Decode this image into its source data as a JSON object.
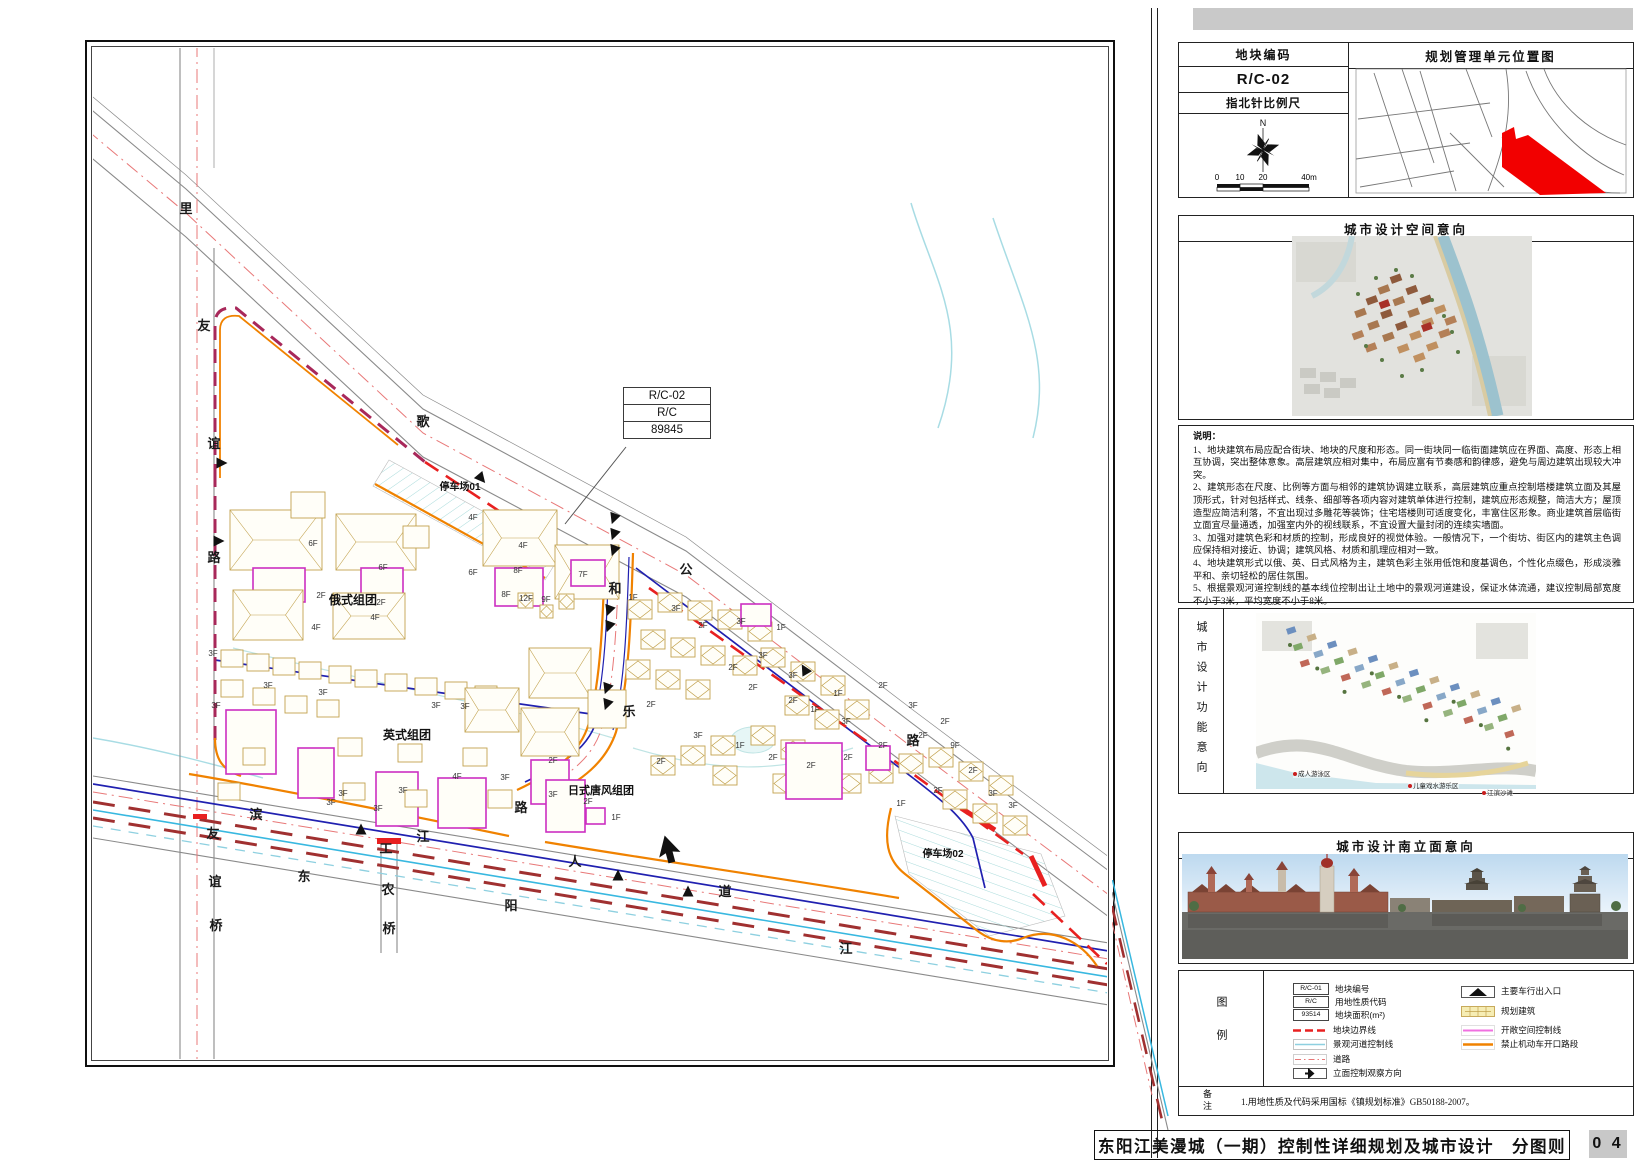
{
  "title_bar": {
    "title": "东阳江美漫城（一期）控制性详细规划及城市设计　分图则",
    "page_no": "0 4"
  },
  "info_table": {
    "code_label": "地块编码",
    "code_value": "R/C-02",
    "compass_label": "指北针比例尺",
    "north": "N",
    "scale_ticks": [
      "0",
      "10",
      "20",
      "40m"
    ],
    "location_title": "规划管理单元位置图"
  },
  "panels": {
    "space_title": "城市设计空间意向",
    "function_title": "城市设计功能意向",
    "elevation_title": "城市设计南立面意向",
    "legend_title": "图例",
    "remark_title": "备注"
  },
  "notes": {
    "title": "说明：",
    "items": [
      "1、地块建筑布局应配合街块、地块的尺度和形态。同一街块同一临街面建筑应在界面、高度、形态上相互协调，突出整体意象。高层建筑应相对集中，布局应富有节奏感和韵律感，避免与周边建筑出现较大冲突。",
      "2、建筑形态在尺度、比例等方面与相邻的建筑协调建立联系，高层建筑应重点控制塔楼建筑立面及其屋顶形式，针对包括样式、线条、细部等各项内容对建筑单体进行控制，建筑应形态规整，简洁大方；屋顶造型应简洁利落，不宜出现过多雕花等装饰；住宅塔楼则可适度变化，丰富住区形象。商业建筑首层临街立面宜尽量通透，加强室内外的视线联系，不宜设置大量封闭的连续实墙面。",
      "3、加强对建筑色彩和材质的控制，形成良好的视觉体验。一般情况下，一个街坊、街区内的建筑主色调应保持相对接近、协调；建筑风格、材质和肌理应相对一致。",
      "4、地块建筑形式以俄、英、日式风格为主，建筑色彩主张用低饱和度基调色，个性化点缀色，形成淡雅平和、亲切轻松的居住氛围。",
      "5、根据景观河道控制线的基本线位控制出让土地中的景观河道建设，保证水体流通，建议控制局部宽度不小于3米，平均宽度不小于8米。",
      "6、基地多砂岩地层，建议开发时整体地坪抬高1-1.5米，便于地下车库与景观河道的设置。",
      "7、建筑造型及立面材质、颜色应以城市设计的空间意向与立面意向为基础进行下一步的初步方案设计，业态功能方面也需与城市设计相衔接。"
    ]
  },
  "function_labels": [
    {
      "t": "成人游泳区",
      "x": 1293,
      "y": 771
    },
    {
      "t": "儿童戏水游乐区",
      "x": 1408,
      "y": 783
    },
    {
      "t": "江滨沙滩",
      "x": 1482,
      "y": 790
    }
  ],
  "legend": {
    "col1": [
      {
        "box": "R/C-01",
        "label": "地块编号"
      },
      {
        "box": "R/C",
        "label": "用地性质代码"
      },
      {
        "box": "93514",
        "label": "地块面积(m²)"
      },
      {
        "type": "red-dash",
        "label": "地块边界线"
      },
      {
        "type": "canal",
        "label": "景观河道控制线"
      },
      {
        "type": "road",
        "label": "道路"
      },
      {
        "type": "view-arrow",
        "label": "立面控制观察方向"
      }
    ],
    "col2": [
      {
        "type": "entry",
        "label": "主要车行出入口"
      },
      {
        "type": "bldg",
        "label": "规划建筑"
      },
      {
        "type": "open",
        "label": "开敞空间控制线"
      },
      {
        "type": "noopen",
        "label": "禁止机动车开口路段"
      }
    ]
  },
  "remark_text": "1.用地性质及代码采用国标《镇规划标准》GB50188-2007。",
  "colors": {
    "tan": "#c2a24e",
    "magenta": "#cc2fc2",
    "navy": "#2020b0",
    "orange": "#f08200",
    "red": "#e82020",
    "maroon": "#a8285a",
    "road_dash": "#e87878",
    "cyan": "#38b8e0",
    "pale_cyan": "#a9dbdb",
    "grey_road": "#8a8a8a"
  },
  "map": {
    "callout": [
      "R/C-02",
      "R/C",
      "89845"
    ],
    "road_labels": [
      [
        93,
        165,
        "里"
      ],
      [
        111,
        282,
        "友"
      ],
      [
        121,
        400,
        "谊"
      ],
      [
        121,
        514,
        "路"
      ],
      [
        120,
        790,
        "友"
      ],
      [
        122,
        838,
        "谊"
      ],
      [
        123,
        882,
        "桥"
      ],
      [
        330,
        378,
        "歌"
      ],
      [
        593,
        526,
        "公"
      ],
      [
        820,
        697,
        "路"
      ],
      [
        522,
        545,
        "和"
      ],
      [
        536,
        668,
        "乐"
      ],
      [
        428,
        764,
        "路"
      ],
      [
        163,
        771,
        "滨"
      ],
      [
        330,
        793,
        "江"
      ],
      [
        482,
        818,
        "人"
      ],
      [
        632,
        848,
        "道"
      ],
      [
        211,
        833,
        "东"
      ],
      [
        418,
        862,
        "阳"
      ],
      [
        753,
        905,
        "江"
      ],
      [
        293,
        805,
        "工"
      ],
      [
        295,
        846,
        "农"
      ],
      [
        296,
        885,
        "桥"
      ]
    ],
    "area_labels": [
      {
        "t": "俄式组团",
        "x": 260,
        "y": 556,
        "fs": 12
      },
      {
        "t": "英式组团",
        "x": 314,
        "y": 691,
        "fs": 12
      },
      {
        "t": "日式唐风组团",
        "x": 508,
        "y": 746,
        "fs": 11
      },
      {
        "t": "停车场01",
        "x": 367,
        "y": 442,
        "fs": 10
      },
      {
        "t": "停车场02",
        "x": 850,
        "y": 809,
        "fs": 10
      }
    ],
    "floor_labels": [
      [
        220,
        498,
        "6F"
      ],
      [
        290,
        522,
        "6F"
      ],
      [
        228,
        550,
        "2F"
      ],
      [
        288,
        557,
        "2F"
      ],
      [
        223,
        582,
        "4F"
      ],
      [
        282,
        572,
        "4F"
      ],
      [
        380,
        472,
        "4F"
      ],
      [
        430,
        500,
        "4F"
      ],
      [
        380,
        527,
        "6F"
      ],
      [
        425,
        525,
        "8F"
      ],
      [
        413,
        549,
        "8F"
      ],
      [
        433,
        553,
        "12F"
      ],
      [
        453,
        554,
        "9F"
      ],
      [
        490,
        529,
        "7F"
      ],
      [
        540,
        552,
        "1F"
      ],
      [
        583,
        563,
        "3F"
      ],
      [
        610,
        580,
        "2F"
      ],
      [
        648,
        576,
        "3F"
      ],
      [
        688,
        582,
        "1F"
      ],
      [
        670,
        610,
        "3F"
      ],
      [
        700,
        630,
        "3F"
      ],
      [
        640,
        622,
        "2F"
      ],
      [
        660,
        642,
        "2F"
      ],
      [
        700,
        655,
        "2F"
      ],
      [
        722,
        664,
        "1F"
      ],
      [
        745,
        648,
        "1F"
      ],
      [
        753,
        676,
        "3F"
      ],
      [
        120,
        608,
        "3F"
      ],
      [
        175,
        640,
        "3F"
      ],
      [
        230,
        647,
        "3F"
      ],
      [
        123,
        660,
        "3F"
      ],
      [
        343,
        660,
        "3F"
      ],
      [
        372,
        661,
        "3F"
      ],
      [
        250,
        748,
        "3F"
      ],
      [
        238,
        757,
        "3F"
      ],
      [
        285,
        763,
        "3F"
      ],
      [
        310,
        745,
        "3F"
      ],
      [
        412,
        732,
        "3F"
      ],
      [
        364,
        731,
        "4F"
      ],
      [
        460,
        715,
        "2F"
      ],
      [
        495,
        756,
        "2F"
      ],
      [
        523,
        772,
        "1F"
      ],
      [
        460,
        749,
        "3F"
      ],
      [
        568,
        716,
        "2F"
      ],
      [
        558,
        659,
        "2F"
      ],
      [
        605,
        690,
        "3F"
      ],
      [
        647,
        700,
        "1F"
      ],
      [
        680,
        712,
        "2F"
      ],
      [
        718,
        720,
        "2F"
      ],
      [
        755,
        712,
        "2F"
      ],
      [
        790,
        700,
        "2F"
      ],
      [
        830,
        690,
        "2F"
      ],
      [
        862,
        700,
        "9F"
      ],
      [
        880,
        725,
        "2F"
      ],
      [
        900,
        748,
        "3F"
      ],
      [
        920,
        760,
        "3F"
      ],
      [
        845,
        745,
        "2F"
      ],
      [
        808,
        758,
        "1F"
      ],
      [
        790,
        640,
        "2F"
      ],
      [
        820,
        660,
        "3F"
      ],
      [
        852,
        676,
        "2F"
      ]
    ],
    "buildings": [
      [
        137,
        462,
        92,
        60,
        "t"
      ],
      [
        243,
        466,
        80,
        56,
        "t"
      ],
      [
        198,
        444,
        34,
        26,
        "t"
      ],
      [
        310,
        478,
        26,
        22,
        "t"
      ],
      [
        160,
        520,
        52,
        34,
        "m"
      ],
      [
        268,
        520,
        42,
        30,
        "m"
      ],
      [
        140,
        542,
        70,
        50,
        "t"
      ],
      [
        240,
        545,
        72,
        46,
        "t"
      ],
      [
        128,
        602,
        22,
        17,
        "t"
      ],
      [
        154,
        606,
        22,
        17,
        "t"
      ],
      [
        180,
        610,
        22,
        17,
        "t"
      ],
      [
        206,
        614,
        22,
        17,
        "t"
      ],
      [
        236,
        618,
        22,
        17,
        "t"
      ],
      [
        262,
        622,
        22,
        17,
        "t"
      ],
      [
        292,
        626,
        22,
        17,
        "t"
      ],
      [
        322,
        630,
        22,
        17,
        "t"
      ],
      [
        352,
        634,
        22,
        17,
        "t"
      ],
      [
        382,
        638,
        22,
        17,
        "t"
      ],
      [
        128,
        632,
        22,
        17,
        "t"
      ],
      [
        160,
        640,
        22,
        17,
        "t"
      ],
      [
        192,
        648,
        22,
        17,
        "t"
      ],
      [
        224,
        652,
        22,
        17,
        "t"
      ],
      [
        133,
        662,
        50,
        64,
        "m"
      ],
      [
        205,
        700,
        36,
        50,
        "m"
      ],
      [
        283,
        724,
        42,
        54,
        "m"
      ],
      [
        345,
        730,
        48,
        50,
        "m"
      ],
      [
        150,
        700,
        22,
        17,
        "t"
      ],
      [
        245,
        690,
        24,
        18,
        "t"
      ],
      [
        305,
        696,
        24,
        18,
        "t"
      ],
      [
        370,
        700,
        24,
        18,
        "t"
      ],
      [
        250,
        735,
        22,
        17,
        "t"
      ],
      [
        312,
        742,
        22,
        17,
        "t"
      ],
      [
        395,
        742,
        24,
        18,
        "t"
      ],
      [
        125,
        735,
        22,
        17,
        "t"
      ],
      [
        390,
        462,
        74,
        56,
        "t"
      ],
      [
        402,
        520,
        48,
        38,
        "m"
      ],
      [
        462,
        497,
        64,
        54,
        "t"
      ],
      [
        478,
        512,
        34,
        26,
        "m"
      ],
      [
        425,
        545,
        15,
        15,
        "d"
      ],
      [
        447,
        557,
        13,
        13,
        "d"
      ],
      [
        466,
        546,
        15,
        15,
        "d"
      ],
      [
        436,
        600,
        62,
        50,
        "t"
      ],
      [
        428,
        660,
        58,
        48,
        "t"
      ],
      [
        438,
        712,
        38,
        44,
        "m"
      ],
      [
        495,
        642,
        38,
        38,
        "t"
      ],
      [
        372,
        640,
        54,
        44,
        "t"
      ],
      [
        535,
        552,
        24,
        19,
        "d"
      ],
      [
        565,
        545,
        24,
        19,
        "d"
      ],
      [
        595,
        553,
        24,
        19,
        "d"
      ],
      [
        625,
        562,
        24,
        19,
        "d"
      ],
      [
        655,
        574,
        24,
        19,
        "d"
      ],
      [
        548,
        582,
        24,
        19,
        "d"
      ],
      [
        578,
        590,
        24,
        19,
        "d"
      ],
      [
        608,
        598,
        24,
        19,
        "d"
      ],
      [
        640,
        608,
        24,
        19,
        "d"
      ],
      [
        533,
        612,
        24,
        19,
        "d"
      ],
      [
        563,
        622,
        24,
        19,
        "d"
      ],
      [
        593,
        632,
        24,
        19,
        "d"
      ],
      [
        668,
        600,
        24,
        19,
        "d"
      ],
      [
        698,
        614,
        24,
        19,
        "d"
      ],
      [
        728,
        628,
        24,
        19,
        "d"
      ],
      [
        692,
        648,
        24,
        19,
        "d"
      ],
      [
        722,
        662,
        24,
        19,
        "d"
      ],
      [
        752,
        652,
        24,
        19,
        "d"
      ],
      [
        658,
        678,
        24,
        19,
        "d"
      ],
      [
        688,
        692,
        24,
        19,
        "d"
      ],
      [
        618,
        688,
        24,
        19,
        "d"
      ],
      [
        588,
        698,
        24,
        19,
        "d"
      ],
      [
        558,
        708,
        24,
        19,
        "d"
      ],
      [
        620,
        718,
        24,
        19,
        "d"
      ],
      [
        680,
        726,
        24,
        19,
        "d"
      ],
      [
        712,
        732,
        24,
        19,
        "d"
      ],
      [
        744,
        726,
        24,
        19,
        "d"
      ],
      [
        776,
        716,
        24,
        19,
        "d"
      ],
      [
        806,
        706,
        24,
        19,
        "d"
      ],
      [
        836,
        700,
        24,
        19,
        "d"
      ],
      [
        866,
        714,
        24,
        19,
        "d"
      ],
      [
        896,
        728,
        24,
        19,
        "d"
      ],
      [
        850,
        742,
        24,
        19,
        "d"
      ],
      [
        880,
        756,
        24,
        19,
        "d"
      ],
      [
        910,
        768,
        24,
        19,
        "d"
      ],
      [
        453,
        732,
        39,
        52,
        "m"
      ],
      [
        493,
        760,
        19,
        16,
        "m"
      ],
      [
        693,
        695,
        56,
        56,
        "m"
      ],
      [
        773,
        698,
        24,
        24,
        "m"
      ],
      [
        648,
        556,
        30,
        22,
        "m"
      ]
    ],
    "triangles": [
      [
        128,
        415,
        90
      ],
      [
        125,
        493,
        90
      ],
      [
        388,
        430,
        140
      ],
      [
        712,
        622,
        -30
      ],
      [
        268,
        782,
        0
      ],
      [
        525,
        828,
        0
      ],
      [
        595,
        844,
        0
      ],
      [
        521,
        470,
        200
      ],
      [
        521,
        486,
        200
      ],
      [
        521,
        502,
        200
      ],
      [
        516,
        562,
        200
      ],
      [
        516,
        578,
        200
      ],
      [
        514,
        640,
        200
      ],
      [
        514,
        656,
        200
      ]
    ]
  }
}
